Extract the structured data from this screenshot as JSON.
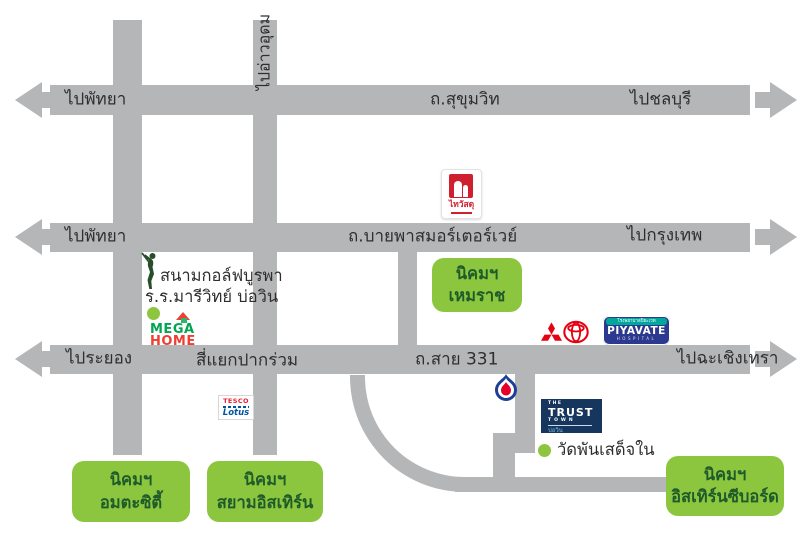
{
  "canvas": {
    "background": "#ffffff",
    "road_color": "#b4b6b8",
    "text_color": "#2e2e2e",
    "estate_green": "#8cc63f",
    "estate_text_color": "#1f5b2a"
  },
  "roads": {
    "sukhumvit": {
      "left_label": "ไปพัทยา",
      "name": "ถ.สุขุมวิท",
      "right_label": "ไปชลบุรี"
    },
    "bypass": {
      "left_label": "ไปพัทยา",
      "name": "ถ.บายพาสมอร์เตอร์เวย์",
      "right_label": "ไปกรุงเทพ"
    },
    "route331": {
      "left_label": "ไประยอง",
      "junction_label": "สี่แยกปากร่วม",
      "name": "ถ.สาย 331",
      "right_label": "ไปฉะเชิงเทรา"
    },
    "ao_udom": {
      "name": "ไปอ่าวอุดม"
    }
  },
  "estates": {
    "hemaraj": {
      "line1": "นิคมฯ",
      "line2": "เหมราช"
    },
    "amata": {
      "line1": "นิคมฯ",
      "line2": "อมตะซิตี้"
    },
    "siam_eastern": {
      "line1": "นิคมฯ",
      "line2": "สยามอิสเทิร์น"
    },
    "eastern_seaboard": {
      "line1": "นิคมฯ",
      "line2": "อิสเทิร์นซีบอร์ด"
    }
  },
  "places": {
    "golf_course": "สนามกอล์ฟบูรพา",
    "school": "ร.ร.มารีวิทย์ บ่อวิน",
    "temple": "วัดพันเสด็จใน"
  },
  "brands": {
    "thaiwatsadu": {
      "name": "ไทวัสดุ",
      "red": "#cf2030"
    },
    "megahome": {
      "word1": "MEGA",
      "word2": "HOME",
      "green": "#00a651",
      "red": "#ef3e33"
    },
    "tesco_lotus": {
      "word1": "TESCO",
      "word2": "Lotus",
      "red": "#ee1c2e",
      "blue": "#00539f"
    },
    "piyavate": {
      "thai_name": "โรงพยาบาลปิยะเวท",
      "name": "PIYAVATE",
      "sub": "HOSPITAL",
      "navy": "#2b3990",
      "teal": "#00a79d"
    },
    "trust_town": {
      "the": "THE",
      "name": "TRUST",
      "town": "TOWN",
      "sub": "บ่อวิน",
      "navy": "#17365d"
    },
    "toyota": {
      "red": "#e50012"
    },
    "mitsubishi": {
      "red": "#e60012"
    },
    "ptt": {
      "blue": "#1c3f94",
      "red": "#e4002b"
    }
  }
}
